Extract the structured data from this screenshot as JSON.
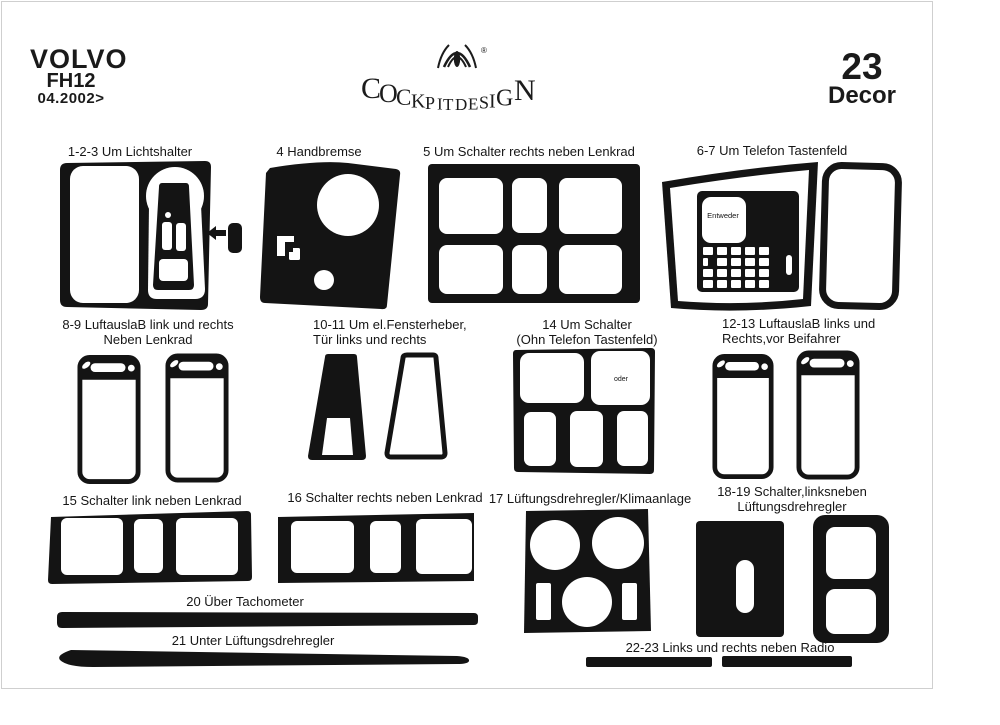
{
  "colors": {
    "ink": "#141414",
    "background": "#ffffff",
    "frame": "#cfcfcf"
  },
  "header": {
    "brand": "VOLVO",
    "model": "FH12",
    "date_range": "04.2002>",
    "logo_text": "COCKPITDESIGN",
    "registered_mark": "®",
    "decor_count": "23",
    "decor_label": "Decor"
  },
  "parts": {
    "p123": {
      "label": "1-2-3 Um Lichtshalter"
    },
    "p4": {
      "label": "4 Handbremse"
    },
    "p5": {
      "label": "5 Um Schalter rechts neben Lenkrad"
    },
    "p67": {
      "label": "6-7 Um Telefon Tastenfeld",
      "keypad_text": "Entweder"
    },
    "p89": {
      "line1": "8-9 LuftauslaB link und rechts",
      "line2": "Neben Lenkrad"
    },
    "p1011": {
      "line1": "10-11 Um el.Fensterheber,",
      "line2": "Tür links  und rechts"
    },
    "p14": {
      "line1": "14 Um Schalter",
      "line2": "(Ohn Telefon Tastenfeld)",
      "inner_text": "oder"
    },
    "p1213": {
      "line1": "12-13 LuftauslaB links und",
      "line2": "Rechts,vor Beifahrer"
    },
    "p15": {
      "label": "15 Schalter link neben Lenkrad"
    },
    "p16": {
      "label": "16 Schalter rechts neben Lenkrad"
    },
    "p17": {
      "label": "17 Lüftungsdrehregler/Klimaanlage"
    },
    "p1819": {
      "line1": "18-19 Schalter,linksneben",
      "line2": "Lüftungsdrehregler"
    },
    "p20": {
      "label": "20 Über Tachometer"
    },
    "p21": {
      "label": "21 Unter Lüftungsdrehregler"
    },
    "p2223": {
      "label": "22-23 Links und rechts neben Radio"
    }
  }
}
